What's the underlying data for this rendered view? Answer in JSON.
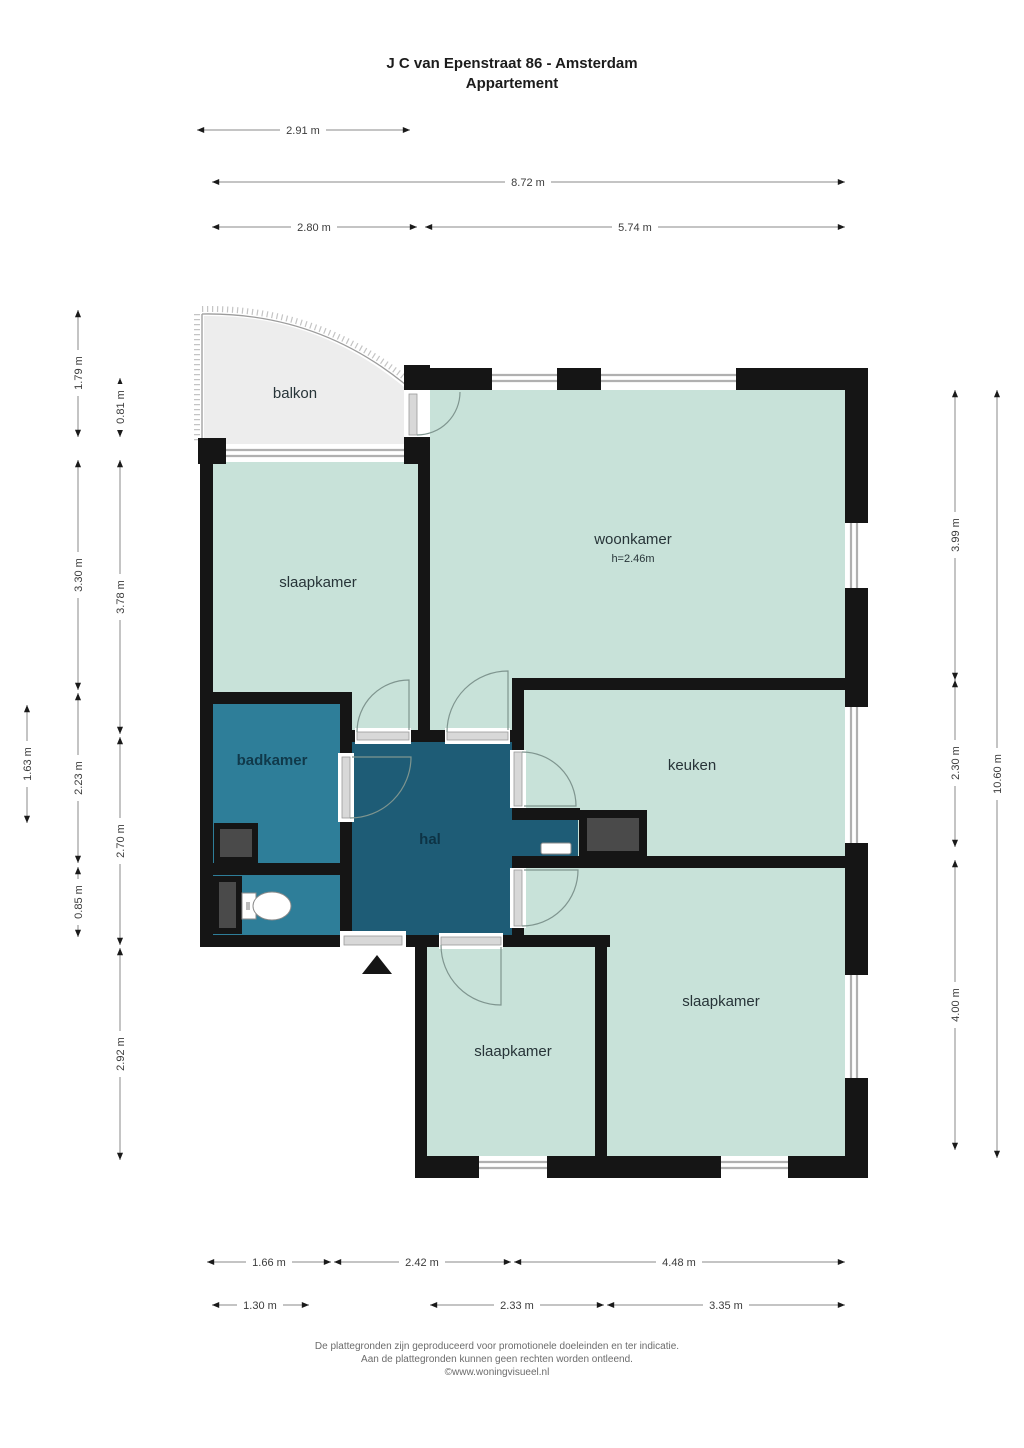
{
  "title": {
    "line1": "J C van Epenstraat 86 - Amsterdam",
    "line2": "Appartement"
  },
  "rooms": {
    "balkon": "balkon",
    "slaapkamer_tl": "slaapkamer",
    "woonkamer": "woonkamer",
    "woonkamer_height": "h=2.46m",
    "badkamer": "badkamer",
    "hal": "hal",
    "keuken": "keuken",
    "slaapkamer_br": "slaapkamer",
    "slaapkamer_bl": "slaapkamer"
  },
  "dimensions": {
    "top": [
      "2.91 m",
      "8.72 m",
      "2.80 m",
      "5.74 m"
    ],
    "left": [
      "1.63 m",
      "1.79 m",
      "3.30 m",
      "2.23 m",
      "0.85 m",
      "0.81 m",
      "3.78 m",
      "2.70 m",
      "2.92 m"
    ],
    "right": [
      "3.99 m",
      "2.30 m",
      "4.00 m",
      "10.60 m"
    ],
    "bottom": [
      "1.66 m",
      "2.42 m",
      "4.48 m",
      "1.30 m",
      "2.33 m",
      "3.35 m"
    ]
  },
  "footer": {
    "line1": "De plattegronden zijn geproduceerd voor promotionele doeleinden en ter indicatie.",
    "line2": "Aan de plattegronden kunnen geen rechten worden ontleend.",
    "line3": "©www.woningvisueel.nl"
  },
  "colors": {
    "room_light": "#c8e2d9",
    "bathroom": "#2e7e99",
    "hall": "#1e5c76",
    "balcony": "#ededed",
    "wall": "#151515",
    "shaft": "#4a4a4a",
    "window_glass": "#b0b0b0",
    "door_strip": "#d8d8d8",
    "door_arc": "#7f958f"
  }
}
